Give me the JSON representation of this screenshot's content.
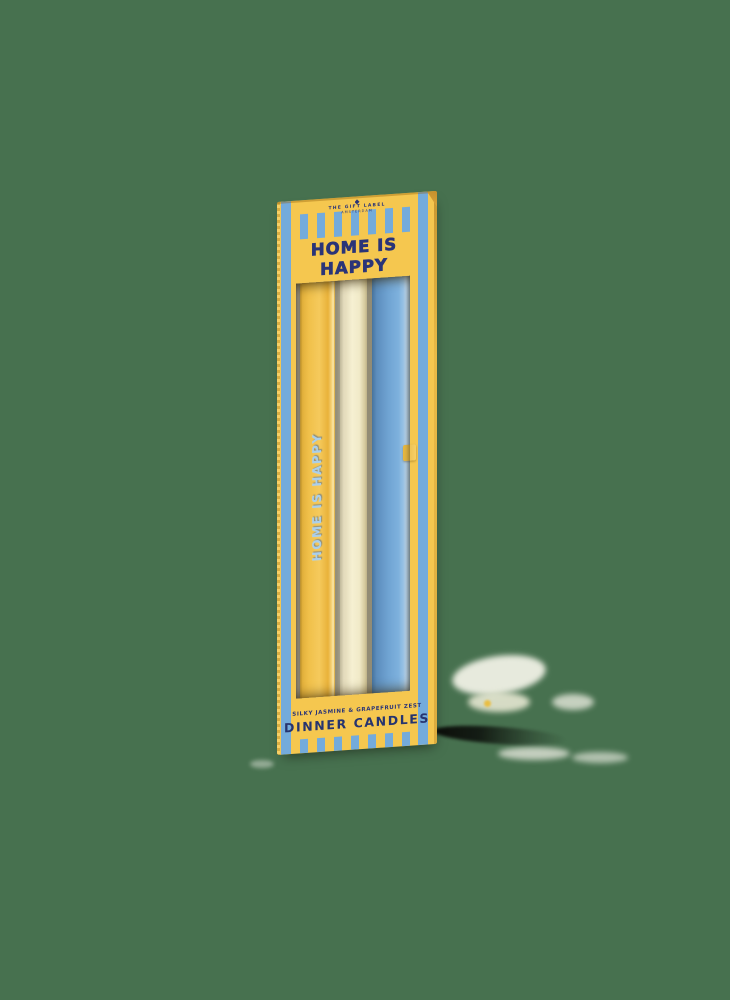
{
  "background_color": "#47714F",
  "box": {
    "brand": {
      "logo": "diamond-monogram-icon",
      "name": "THE GIFT LABEL",
      "city": "AMSTERDAM"
    },
    "title": {
      "line1": "HOME IS",
      "line2": "HAPPY"
    },
    "candle": {
      "text": "HOME IS HAPPY"
    },
    "labels": {
      "scent": "SILKY JASMINE & GRAPEFRUIT ZEST",
      "type": "DINNER CANDLES"
    },
    "contents": [
      "yellow-candle",
      "cream-candle",
      "blue-flower-candle"
    ],
    "colors": {
      "background_green": "#47714F",
      "box_yellow": "#F5C74F",
      "stripe_blue": "#74ABDB",
      "text_navy": "#2A3478",
      "candle_yellow": "#F3C651",
      "candle_cream": "#F7F1D4",
      "candle_blue": "#6FA3D2",
      "candle_text_blue": "#AACFEA",
      "flower_orange": "#F3A83E",
      "flower_orange_dark": "#E18F2A",
      "leaf_green": "#5C8C3E"
    }
  }
}
